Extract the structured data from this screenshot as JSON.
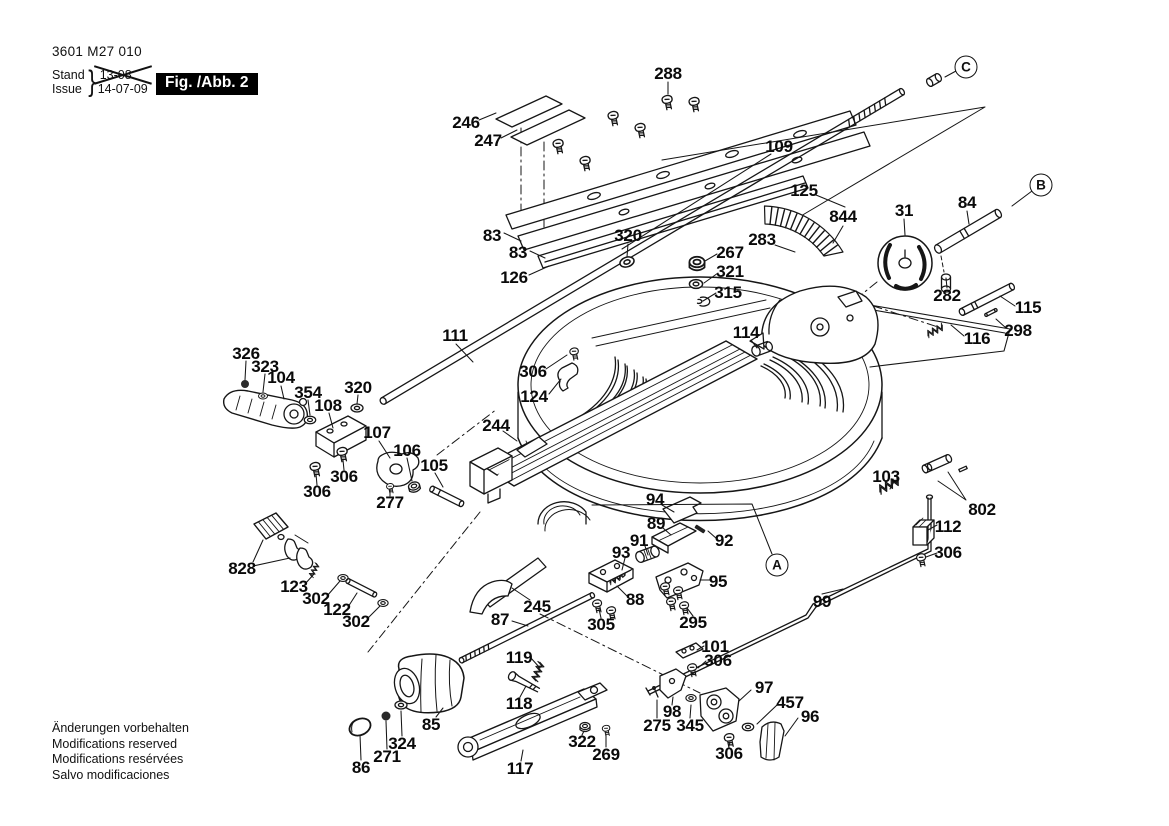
{
  "header": {
    "part_number": "3601 M27 010",
    "stand_label": "Stand",
    "issue_label": "Issue",
    "brace": "}",
    "stand_value": "13-08",
    "issue_value": "14-07-09",
    "figure_label": "Fig. /Abb. 2"
  },
  "footer": {
    "line1": "Änderungen vorbehalten",
    "line2": "Modifications reserved",
    "line3": "Modifications resérvées",
    "line4": "Salvo modificaciones"
  },
  "diagram": {
    "ink_color": "#161616",
    "ref_markers": [
      {
        "id": "C",
        "x": 966,
        "y": 67
      },
      {
        "id": "B",
        "x": 1041,
        "y": 185
      },
      {
        "id": "A",
        "x": 777,
        "y": 565
      }
    ],
    "callouts": [
      {
        "id": "288",
        "x": 668,
        "y": 74
      },
      {
        "id": "246",
        "x": 466,
        "y": 123
      },
      {
        "id": "247",
        "x": 488,
        "y": 141
      },
      {
        "id": "109",
        "x": 779,
        "y": 147
      },
      {
        "id": "83",
        "x": 492,
        "y": 236
      },
      {
        "id": "83",
        "x": 518,
        "y": 253
      },
      {
        "id": "126",
        "x": 514,
        "y": 278
      },
      {
        "id": "320",
        "x": 628,
        "y": 236
      },
      {
        "id": "125",
        "x": 804,
        "y": 191
      },
      {
        "id": "844",
        "x": 843,
        "y": 217
      },
      {
        "id": "283",
        "x": 762,
        "y": 240
      },
      {
        "id": "267",
        "x": 730,
        "y": 253
      },
      {
        "id": "321",
        "x": 730,
        "y": 272
      },
      {
        "id": "315",
        "x": 728,
        "y": 293
      },
      {
        "id": "31",
        "x": 904,
        "y": 211
      },
      {
        "id": "84",
        "x": 967,
        "y": 203
      },
      {
        "id": "282",
        "x": 947,
        "y": 296
      },
      {
        "id": "115",
        "x": 1028,
        "y": 308
      },
      {
        "id": "116",
        "x": 977,
        "y": 339
      },
      {
        "id": "298",
        "x": 1018,
        "y": 331
      },
      {
        "id": "111",
        "x": 455,
        "y": 336
      },
      {
        "id": "114",
        "x": 746,
        "y": 333
      },
      {
        "id": "306",
        "x": 533,
        "y": 372
      },
      {
        "id": "124",
        "x": 534,
        "y": 397
      },
      {
        "id": "326",
        "x": 246,
        "y": 354
      },
      {
        "id": "323",
        "x": 265,
        "y": 367
      },
      {
        "id": "104",
        "x": 281,
        "y": 378
      },
      {
        "id": "354",
        "x": 308,
        "y": 393
      },
      {
        "id": "108",
        "x": 328,
        "y": 406
      },
      {
        "id": "320",
        "x": 358,
        "y": 388
      },
      {
        "id": "107",
        "x": 377,
        "y": 433
      },
      {
        "id": "106",
        "x": 407,
        "y": 451
      },
      {
        "id": "105",
        "x": 434,
        "y": 466
      },
      {
        "id": "306",
        "x": 344,
        "y": 477
      },
      {
        "id": "306",
        "x": 317,
        "y": 492
      },
      {
        "id": "277",
        "x": 390,
        "y": 503
      },
      {
        "id": "244",
        "x": 496,
        "y": 426
      },
      {
        "id": "94",
        "x": 655,
        "y": 500
      },
      {
        "id": "89",
        "x": 656,
        "y": 524
      },
      {
        "id": "91",
        "x": 639,
        "y": 541
      },
      {
        "id": "92",
        "x": 724,
        "y": 541
      },
      {
        "id": "93",
        "x": 621,
        "y": 553
      },
      {
        "id": "95",
        "x": 718,
        "y": 582
      },
      {
        "id": "88",
        "x": 635,
        "y": 600
      },
      {
        "id": "103",
        "x": 886,
        "y": 477
      },
      {
        "id": "802",
        "x": 982,
        "y": 510
      },
      {
        "id": "112",
        "x": 948,
        "y": 527
      },
      {
        "id": "306",
        "x": 948,
        "y": 553
      },
      {
        "id": "828",
        "x": 242,
        "y": 569
      },
      {
        "id": "123",
        "x": 294,
        "y": 587
      },
      {
        "id": "302",
        "x": 316,
        "y": 599
      },
      {
        "id": "122",
        "x": 337,
        "y": 610
      },
      {
        "id": "302",
        "x": 356,
        "y": 622
      },
      {
        "id": "245",
        "x": 537,
        "y": 607
      },
      {
        "id": "87",
        "x": 500,
        "y": 620
      },
      {
        "id": "305",
        "x": 601,
        "y": 625
      },
      {
        "id": "295",
        "x": 693,
        "y": 623
      },
      {
        "id": "99",
        "x": 822,
        "y": 602
      },
      {
        "id": "119",
        "x": 519,
        "y": 658
      },
      {
        "id": "101",
        "x": 715,
        "y": 647
      },
      {
        "id": "306",
        "x": 718,
        "y": 661
      },
      {
        "id": "118",
        "x": 519,
        "y": 704
      },
      {
        "id": "97",
        "x": 764,
        "y": 688
      },
      {
        "id": "457",
        "x": 790,
        "y": 703
      },
      {
        "id": "96",
        "x": 810,
        "y": 717
      },
      {
        "id": "98",
        "x": 672,
        "y": 712
      },
      {
        "id": "275",
        "x": 657,
        "y": 726
      },
      {
        "id": "345",
        "x": 690,
        "y": 726
      },
      {
        "id": "306",
        "x": 729,
        "y": 754
      },
      {
        "id": "85",
        "x": 431,
        "y": 725
      },
      {
        "id": "324",
        "x": 402,
        "y": 744
      },
      {
        "id": "271",
        "x": 387,
        "y": 757
      },
      {
        "id": "86",
        "x": 361,
        "y": 768
      },
      {
        "id": "117",
        "x": 520,
        "y": 769
      },
      {
        "id": "322",
        "x": 582,
        "y": 742
      },
      {
        "id": "269",
        "x": 606,
        "y": 755
      }
    ]
  }
}
